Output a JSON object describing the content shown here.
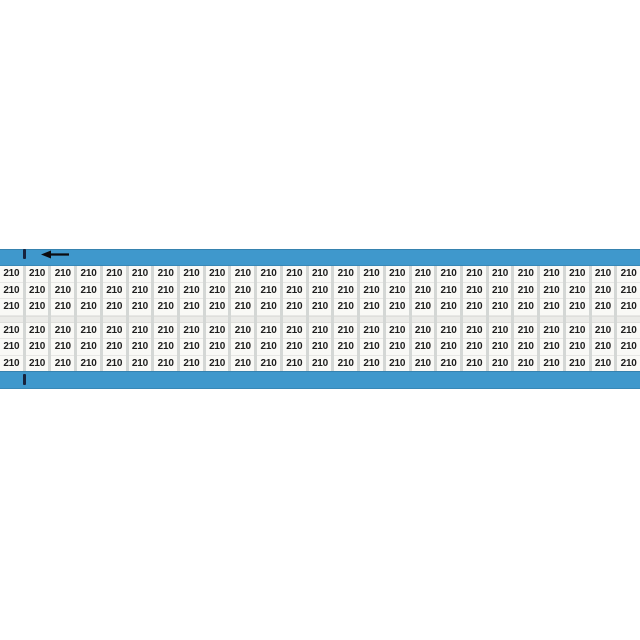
{
  "product_card": {
    "marker_text": "210",
    "columns": 25,
    "rows_per_group": 3,
    "groups": 2,
    "total_markers": 150
  },
  "icons": {
    "left_arrow": "←"
  },
  "colors": {
    "page_bg": "#ffffff",
    "tape_blue": "#3f98cc",
    "label_area_bg": "#d4d7d5",
    "group_gap_bg": "#ebebe8",
    "label_white": "#f9f9f6",
    "marker_text": "#1e1e1e",
    "arrow_black": "#0c0c10",
    "tick_navy": "#17233d"
  }
}
